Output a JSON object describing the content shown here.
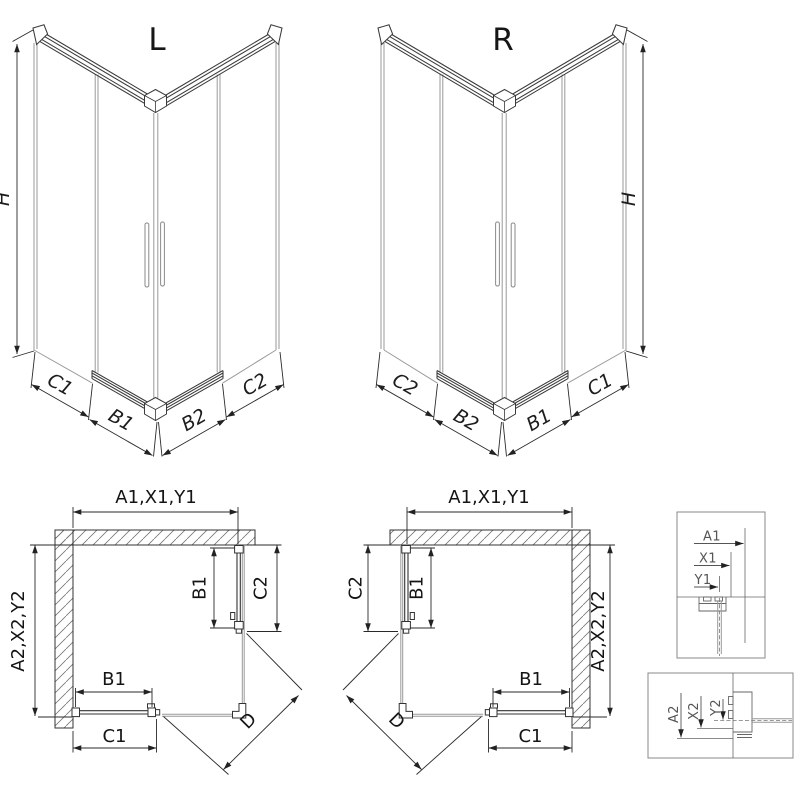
{
  "figure": {
    "type": "shower-enclosure-technical-drawing",
    "colors": {
      "line": "#333333",
      "glass": "#999999",
      "hatch": "#777777",
      "text": "#141414",
      "detail_text": "#555555",
      "background": "#ffffff"
    },
    "views": {
      "iso_left": {
        "title": "L",
        "height_dim": "H",
        "bottom_dims": [
          "C1",
          "B1",
          "B2",
          "C2"
        ]
      },
      "iso_right": {
        "title": "R",
        "height_dim": "H",
        "bottom_dims": [
          "C2",
          "B2",
          "B1",
          "C1"
        ]
      },
      "plan_left": {
        "top_dim": "A1,X1,Y1",
        "side_dim": "A2,X2,Y2",
        "door_side_dim": "B1",
        "fixed_side_dim": "C2",
        "door_bottom_dim": "B1",
        "fixed_bottom_dim": "C1",
        "diagonal_dim": "D"
      },
      "plan_right": {
        "top_dim": "A1,X1,Y1",
        "side_dim": "A2,X2,Y2",
        "door_side_dim": "B1",
        "fixed_side_dim": "C2",
        "door_bottom_dim": "B1",
        "fixed_bottom_dim": "C1",
        "diagonal_dim": "D"
      },
      "detail_top": {
        "dims": [
          "A1",
          "X1",
          "Y1"
        ]
      },
      "detail_bottom": {
        "dims": [
          "A2",
          "X2",
          "Y2"
        ]
      }
    }
  }
}
